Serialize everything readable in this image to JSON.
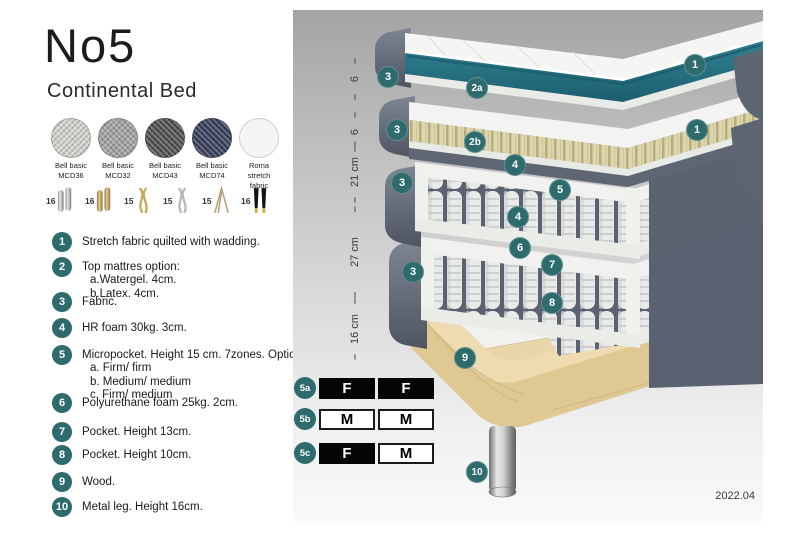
{
  "header": {
    "title": "No5",
    "subtitle": "Continental Bed"
  },
  "fabrics": {
    "items": [
      {
        "line1": "Bell basic",
        "line2": "MCD36",
        "color": "#d6d5d0"
      },
      {
        "line1": "Bell basic",
        "line2": "MCD32",
        "color": "#a3a2a0"
      },
      {
        "line1": "Bell basic",
        "line2": "MCD43",
        "color": "#4e4e4c"
      },
      {
        "line1": "Bell basic",
        "line2": "MCD74",
        "color": "#343a5a"
      },
      {
        "line1": "Roma",
        "line2": "stretch fabric",
        "color": "#f4f5f4"
      }
    ]
  },
  "legs": {
    "items": [
      {
        "height": "16",
        "type": "cylinder-silver"
      },
      {
        "height": "16",
        "type": "cylinder-gold"
      },
      {
        "height": "15",
        "type": "twisted-gold"
      },
      {
        "height": "15",
        "type": "twisted-silver"
      },
      {
        "height": "15",
        "type": "hairpin"
      },
      {
        "height": "16",
        "type": "black-gold-tip"
      }
    ]
  },
  "features": [
    {
      "num": "1",
      "text": "Stretch fabric quilted with wadding."
    },
    {
      "num": "2",
      "text": "Top mattres option:",
      "sub": [
        "a.Watergel. 4cm.",
        "b.Latex. 4cm."
      ]
    },
    {
      "num": "3",
      "text": "Fabric."
    },
    {
      "num": "4",
      "text": "HR foam 30kg. 3cm."
    },
    {
      "num": "5",
      "text": "Micropocket. Height 15 cm. 7zones. Option:",
      "sub": [
        "a. Firm/ firm",
        "b. Medium/ medium",
        "c. Firm/ medium"
      ]
    },
    {
      "num": "6",
      "text": "Polyurethane foam 25kg. 2cm."
    },
    {
      "num": "7",
      "text": "Pocket. Height 13cm."
    },
    {
      "num": "8",
      "text": "Pocket. Height 10cm."
    },
    {
      "num": "9",
      "text": "Wood."
    },
    {
      "num": "10",
      "text": "Metal leg. Height 16cm."
    }
  ],
  "diagram": {
    "dimensions": [
      {
        "label": "6",
        "center": 69,
        "length": 42
      },
      {
        "label": "6",
        "center": 122,
        "length": 40
      },
      {
        "label": "21 cm",
        "center": 162,
        "length": 62
      },
      {
        "label": "27 cm",
        "center": 242,
        "length": 92
      },
      {
        "label": "16 cm",
        "center": 319,
        "length": 62
      }
    ],
    "callouts": [
      {
        "label": "1",
        "x": 402,
        "y": 55
      },
      {
        "label": "2a",
        "x": 184,
        "y": 78
      },
      {
        "label": "3",
        "x": 95,
        "y": 67
      },
      {
        "label": "1",
        "x": 404,
        "y": 120
      },
      {
        "label": "2b",
        "x": 182,
        "y": 132
      },
      {
        "label": "3",
        "x": 104,
        "y": 120
      },
      {
        "label": "4",
        "x": 222,
        "y": 155
      },
      {
        "label": "5",
        "x": 267,
        "y": 180
      },
      {
        "label": "4",
        "x": 225,
        "y": 207
      },
      {
        "label": "3",
        "x": 109,
        "y": 173
      },
      {
        "label": "6",
        "x": 227,
        "y": 238
      },
      {
        "label": "7",
        "x": 259,
        "y": 255
      },
      {
        "label": "3",
        "x": 120,
        "y": 262
      },
      {
        "label": "8",
        "x": 259,
        "y": 293
      },
      {
        "label": "9",
        "x": 172,
        "y": 348
      },
      {
        "label": "10",
        "x": 184,
        "y": 462
      }
    ],
    "firmness": [
      {
        "label": "5a",
        "cells": [
          {
            "text": "F",
            "variant": "dark"
          },
          {
            "text": "F",
            "variant": "dark"
          }
        ]
      },
      {
        "label": "5b",
        "cells": [
          {
            "text": "M",
            "variant": "light"
          },
          {
            "text": "M",
            "variant": "light"
          }
        ]
      },
      {
        "label": "5c",
        "cells": [
          {
            "text": "F",
            "variant": "dark"
          },
          {
            "text": "M",
            "variant": "light"
          }
        ]
      }
    ],
    "version": "2022.04"
  },
  "colors": {
    "accent_teal": "#2e6b6c",
    "watergel_teal": "#2a7686",
    "fabric_gray": "#5b6270",
    "latex_tan": "#ddd5ab",
    "wood": "#e6d3a7",
    "metal_silver": "#c0c0c0"
  }
}
